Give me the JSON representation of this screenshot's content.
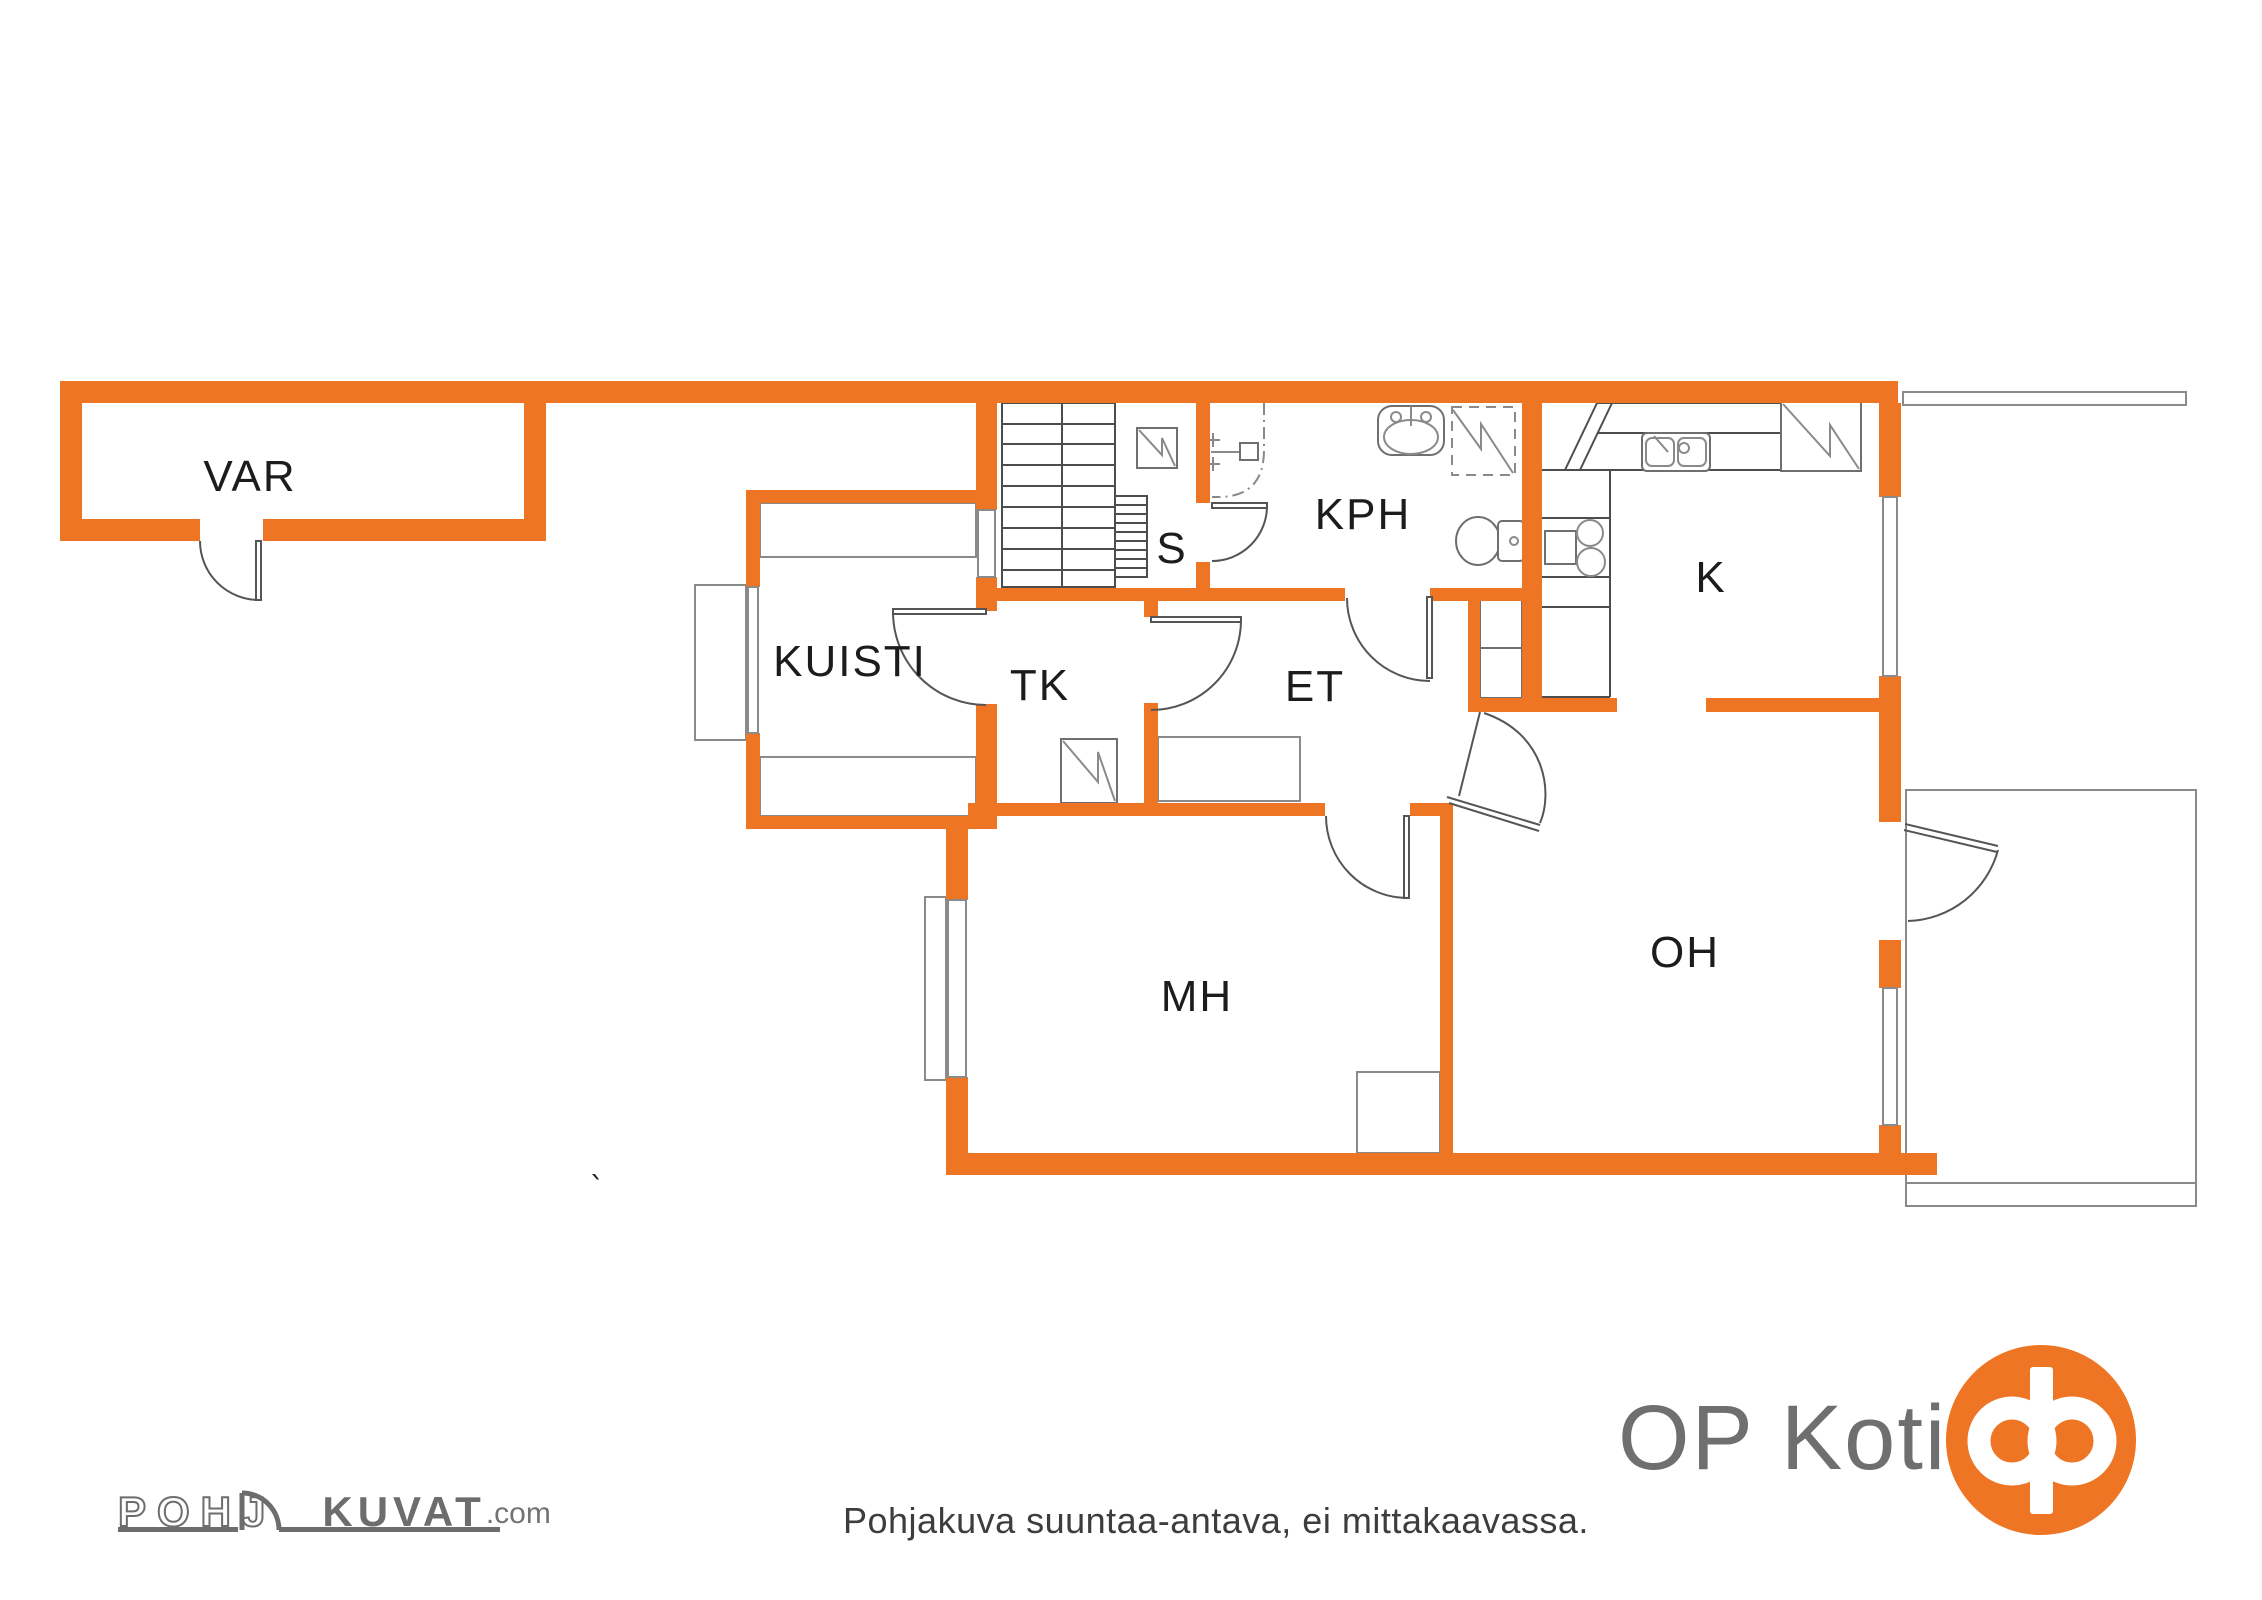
{
  "rooms": {
    "var": {
      "label": "VAR"
    },
    "kuisti": {
      "label": "KUISTI"
    },
    "tk": {
      "label": "TK"
    },
    "s": {
      "label": "S"
    },
    "kph": {
      "label": "KPH"
    },
    "k": {
      "label": "K"
    },
    "et": {
      "label": "ET"
    },
    "mh": {
      "label": "MH"
    },
    "oh": {
      "label": "OH"
    }
  },
  "footer": {
    "disclaimer": "Pohjakuva suuntaa-antava, ei mittakaavassa.",
    "brand_name": "OP Koti",
    "watermark": {
      "part1": "POHJ",
      "part2": "KUVAT",
      "suffix": ".com"
    }
  },
  "artifact_mark": "`",
  "colors": {
    "wall_orange": "#EE7523",
    "line_gray": "#4d4d4d",
    "fixture_gray": "#8a8a8a",
    "logo_gray": "#6F6F71",
    "text_dark": "#1c1c1c"
  }
}
